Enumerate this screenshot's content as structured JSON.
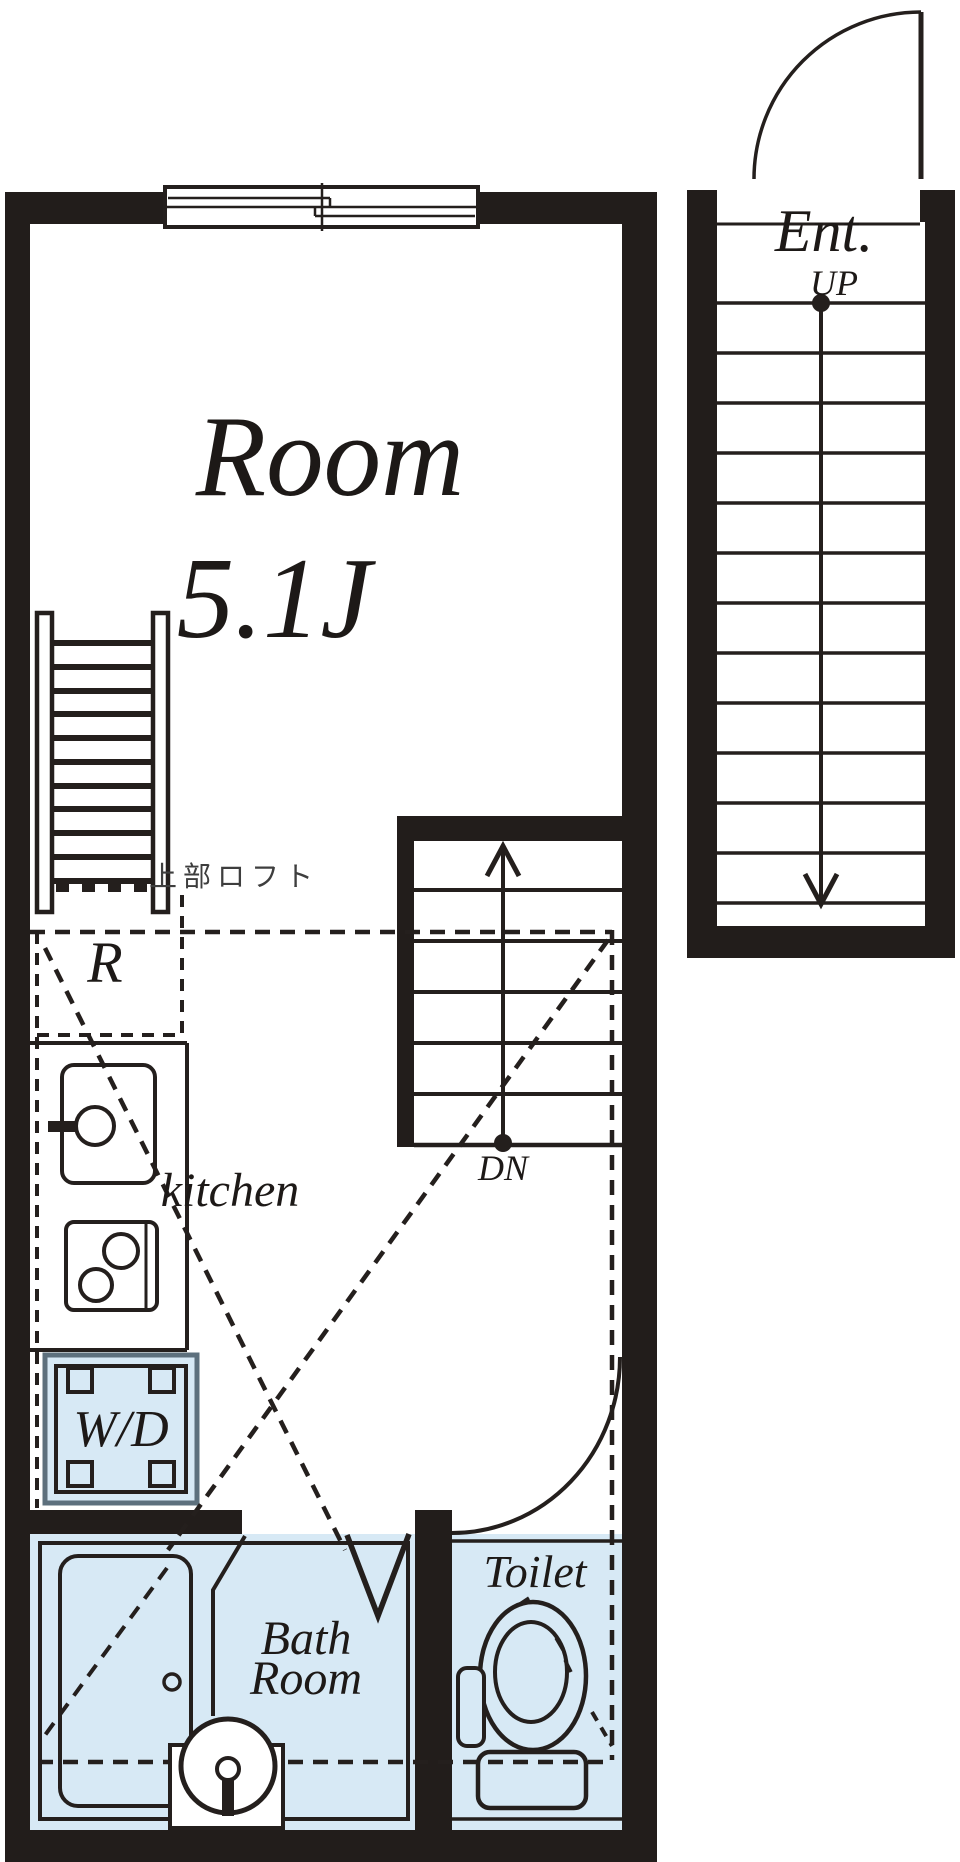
{
  "title": "Studio apartment floor plan",
  "colors": {
    "wall": "#221d1b",
    "line": "#241f1d",
    "wet_area_fill": "#d7e9f5",
    "wd_border": "#5d707d",
    "loft_text": "#3e3e3e",
    "background": "#ffffff"
  },
  "labels": {
    "room": {
      "name": "Room",
      "size": "5.1J"
    },
    "loft": "上部ロフト",
    "refrigerator": "R",
    "kitchen": "kitchen",
    "washer_dryer": "W/D",
    "bath": {
      "line1": "Bath",
      "line2": "Room"
    },
    "toilet": "Toilet",
    "stairs_down": "DN",
    "entrance": "Ent.",
    "stairs_up": "UP"
  }
}
